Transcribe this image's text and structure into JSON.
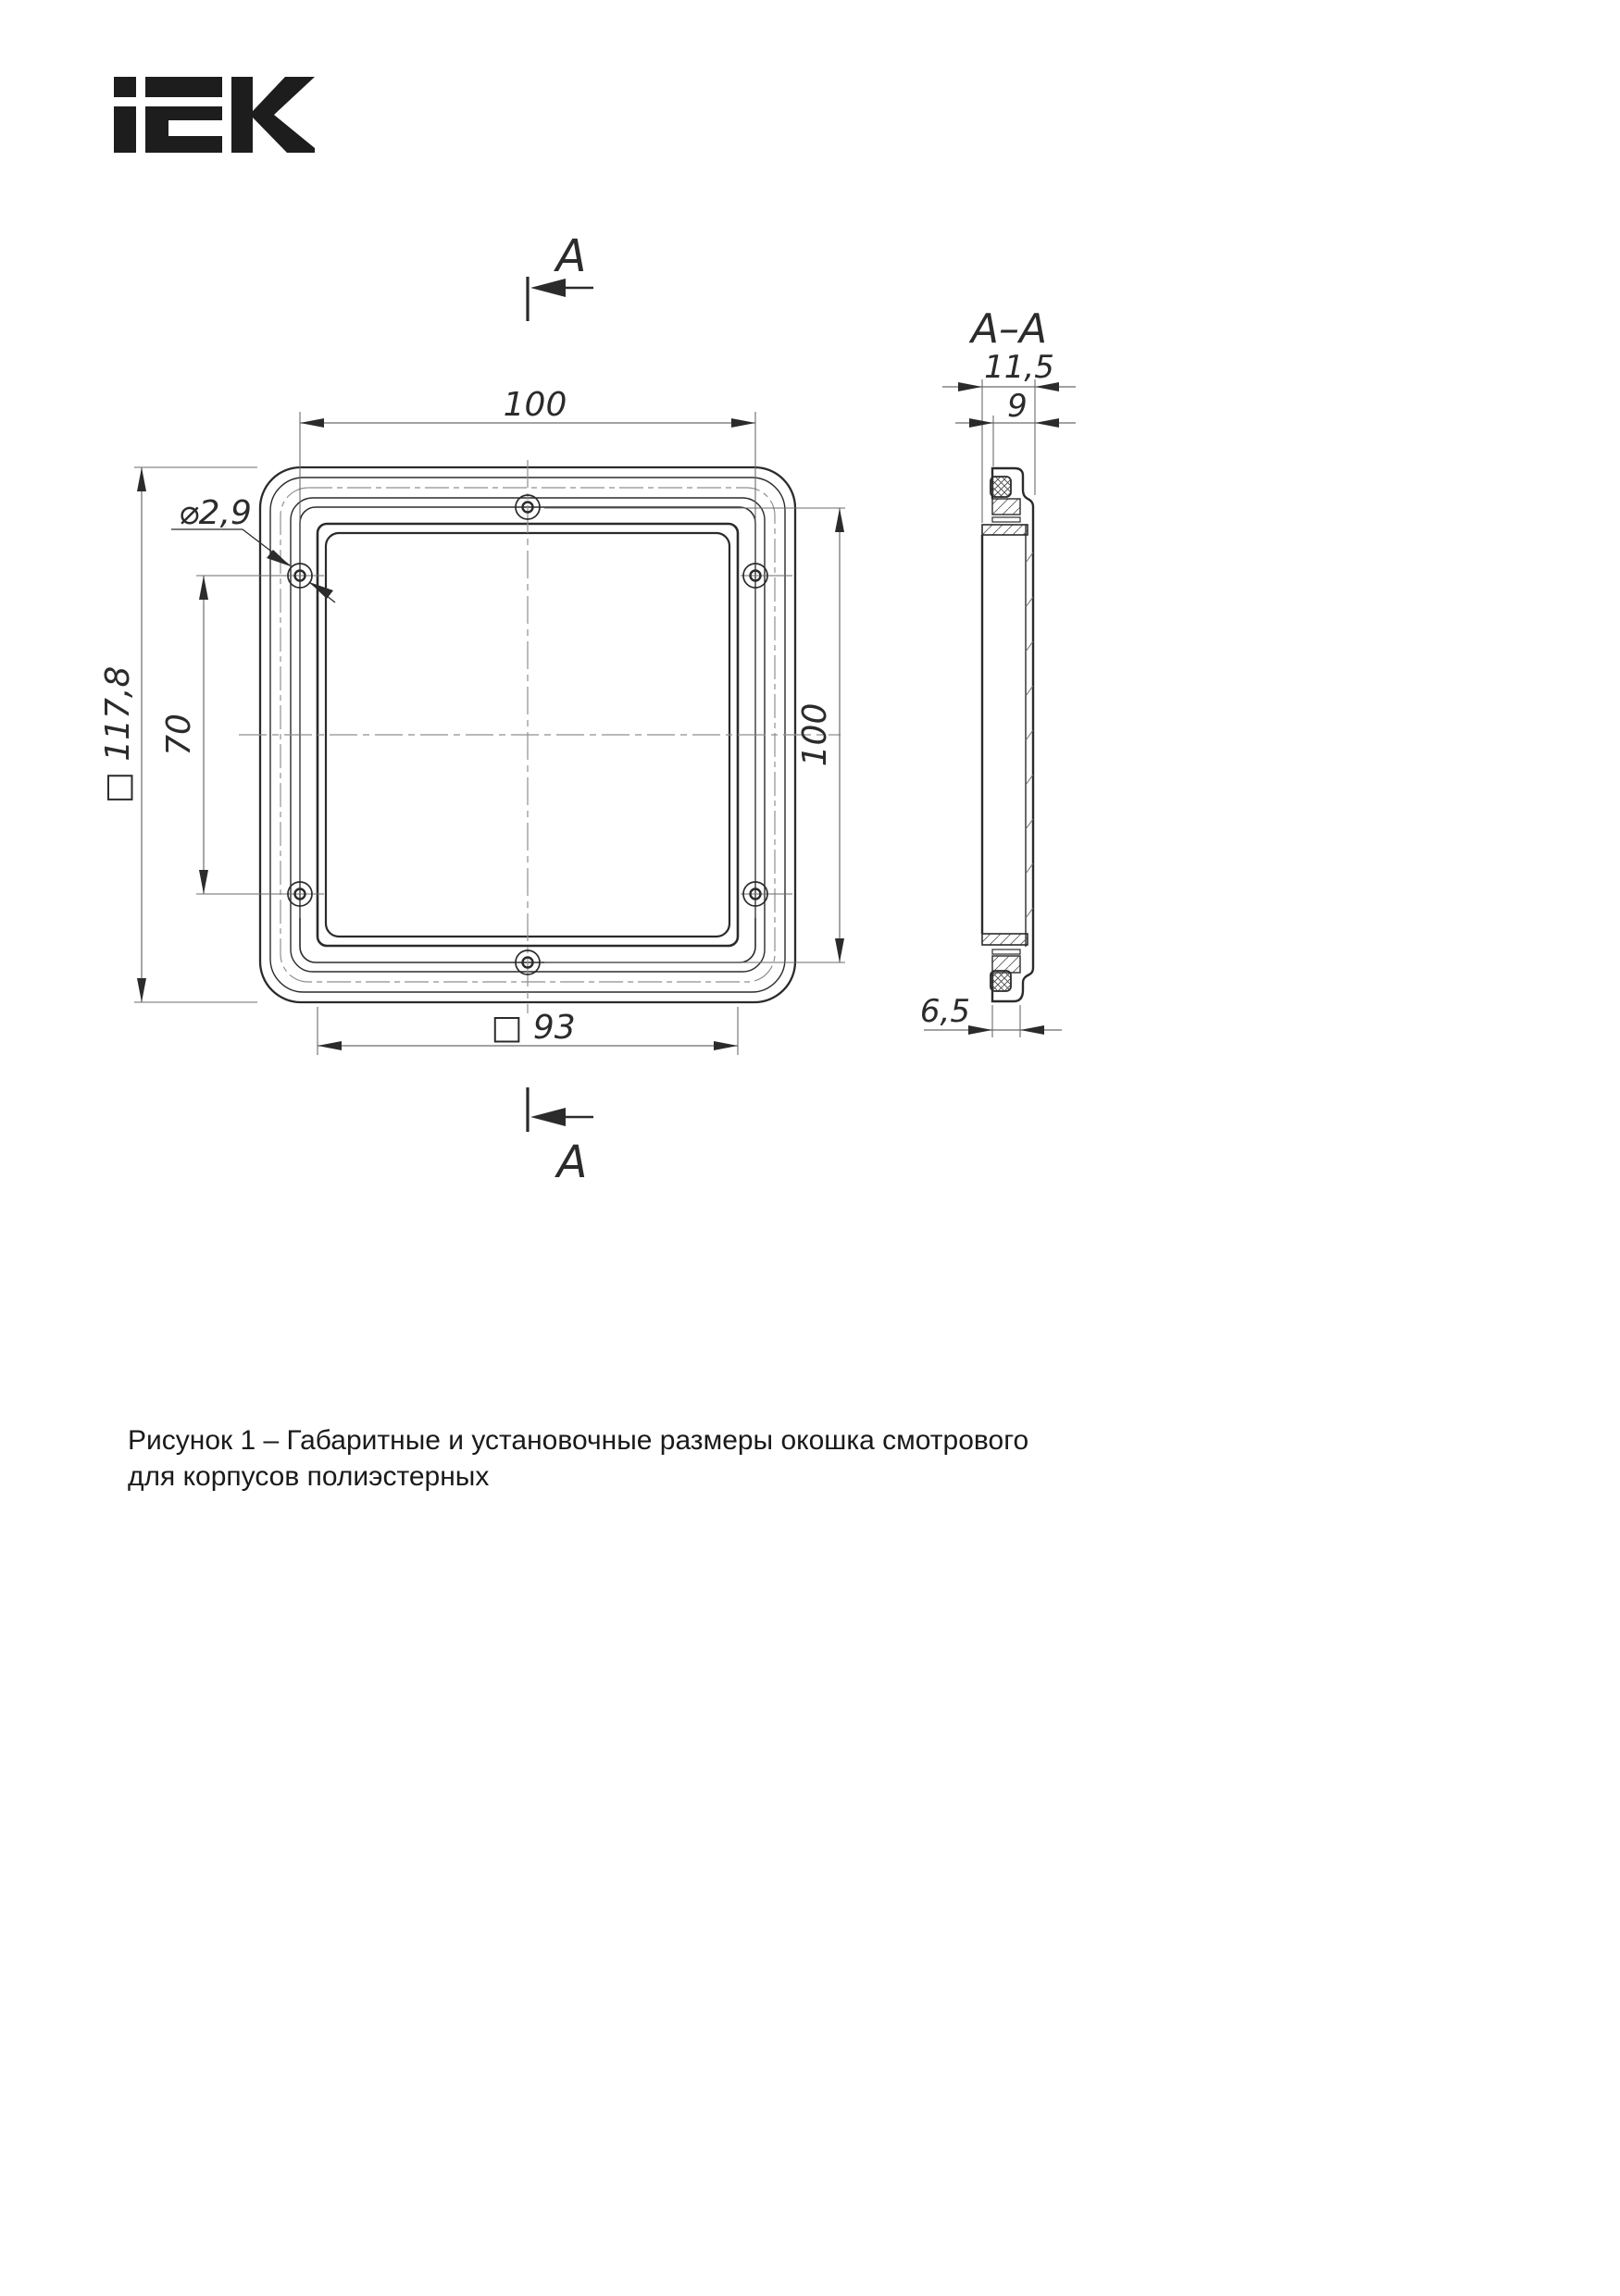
{
  "logo": {
    "name": "IEK"
  },
  "section_markers": {
    "top_label": "A",
    "bottom_label": "A"
  },
  "front_view": {
    "dim_top_width": "100",
    "dim_outer_square": "□ 117,8",
    "dim_hole_vertical_spacing": "70",
    "dim_right_height": "100",
    "dim_hole_diameter": "⌀2,9",
    "dim_inner_square": "□ 93"
  },
  "section_view": {
    "title": "A–A",
    "dim_total_depth": "11,5",
    "dim_body_depth": "9",
    "dim_clip_width": "6,5"
  },
  "caption": {
    "line1": "Рисунок 1 – Габаритные и установочные размеры окошка смотрового",
    "line2": "для корпусов полиэстерных"
  },
  "colors": {
    "ink": "#2b2b2b",
    "auxiliary_lines": "#6b6b6b",
    "centerlines": "#8f8f8f",
    "background": "#ffffff"
  }
}
